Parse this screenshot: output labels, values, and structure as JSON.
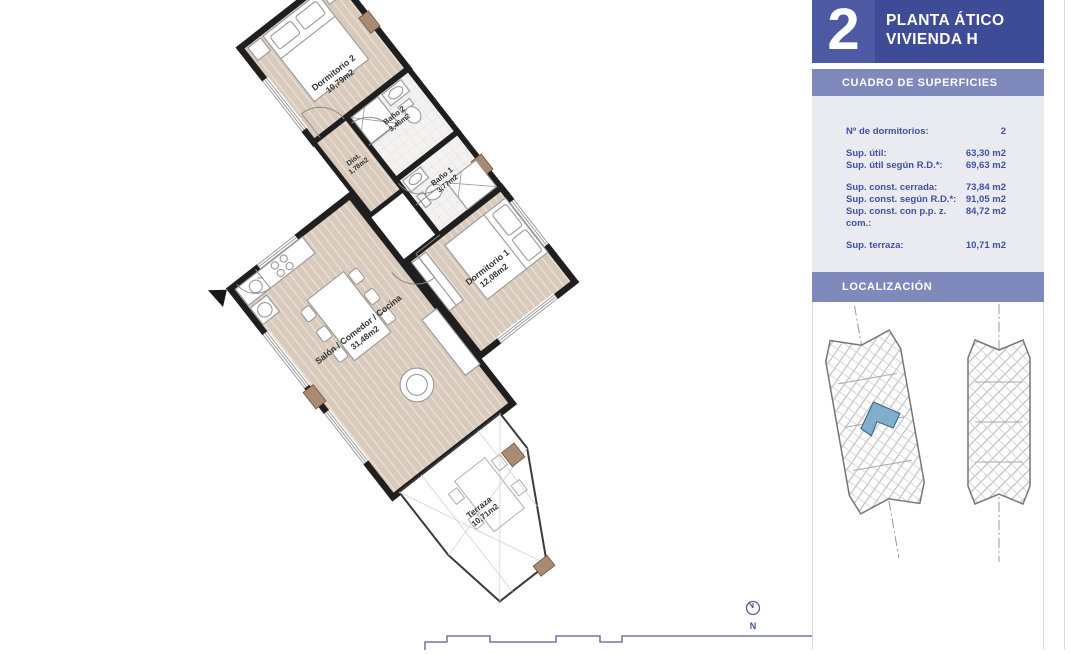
{
  "panel": {
    "floor_number": "2",
    "title_line1": "PLANTA ÁTICO",
    "title_line2": "VIVIENDA H",
    "section_superficies": "CUADRO DE SUPERFICIES",
    "section_localizacion": "LOCALIZACIÓN",
    "table": {
      "rows": [
        {
          "label": "Nº de dormitorios:",
          "value": "2"
        },
        {
          "label": "Sup. útil:",
          "value": "63,30 m2"
        },
        {
          "label": "Sup. útil según R.D.*:",
          "value": "69,63 m2"
        },
        {
          "label": "Sup. const. cerrada:",
          "value": "73,84 m2"
        },
        {
          "label": "Sup. const. según R.D.*:",
          "value": "91,05 m2"
        },
        {
          "label": "Sup. const. con p.p. z. com.:",
          "value": "84,72 m2"
        },
        {
          "label": "Sup. terraza:",
          "value": "10,71 m2"
        }
      ]
    }
  },
  "plan": {
    "rooms": [
      {
        "name": "Dormitorio 2",
        "area": "10,79m2"
      },
      {
        "name": "Baño 2",
        "area": "3,46m2"
      },
      {
        "name": "Dist.",
        "area": "1,78m2"
      },
      {
        "name": "Baño 1",
        "area": "3,77m2"
      },
      {
        "name": "Dormitorio 1",
        "area": "12,08m2"
      },
      {
        "name": "Salón / Comedor / Cocina",
        "area": "31,48m2"
      },
      {
        "name": "Terraza",
        "area": "10,71m2"
      }
    ],
    "compass_label": "N"
  },
  "colors": {
    "header": "#3e4b96",
    "header_tile": "#4d59a3",
    "section_bar": "#7f89bb",
    "table_bg": "#eaebf1",
    "accent_text": "#4050a0",
    "wall": "#1f1f1f",
    "wood_floor": "#d8cabc",
    "pillar": "#aa8a70",
    "highlighted_unit": "#82aecd"
  }
}
